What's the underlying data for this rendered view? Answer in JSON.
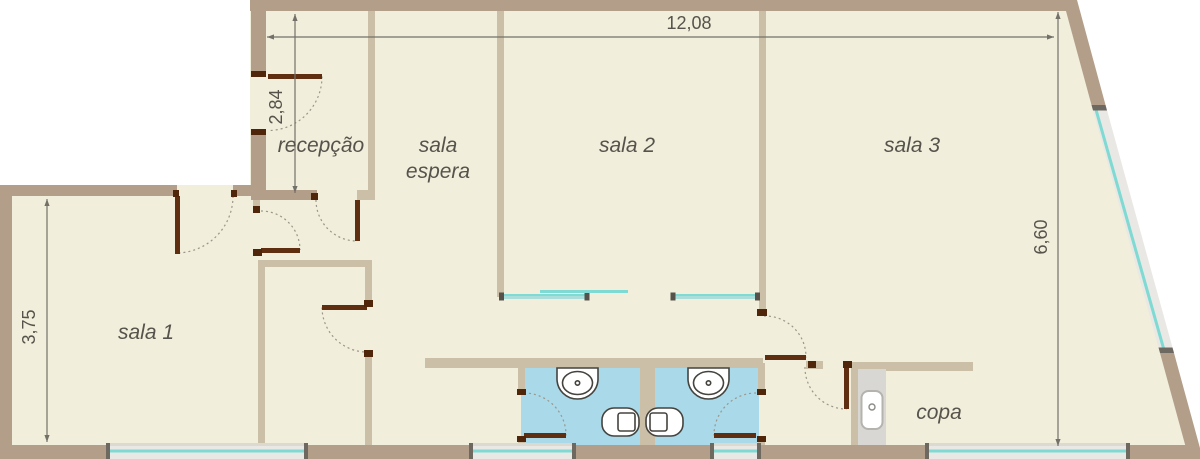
{
  "plan": {
    "type": "floor-plan",
    "rooms": [
      {
        "name": "recepcao",
        "label": "recepção"
      },
      {
        "name": "sala-espera",
        "label1": "sala",
        "label2": "espera"
      },
      {
        "name": "sala-2",
        "label": "sala 2"
      },
      {
        "name": "sala-3",
        "label": "sala 3"
      },
      {
        "name": "sala-1",
        "label": "sala 1"
      },
      {
        "name": "copa",
        "label": "copa"
      }
    ],
    "dimensions": [
      {
        "name": "overall-width",
        "label": "12,08",
        "orientation": "horizontal"
      },
      {
        "name": "recepcao-depth",
        "label": "2,84",
        "orientation": "vertical"
      },
      {
        "name": "sala-1-depth",
        "label": "3,75",
        "orientation": "vertical"
      },
      {
        "name": "right-side-height",
        "label": "6,60",
        "orientation": "vertical"
      }
    ],
    "fixtures": [
      "bathroom-sink",
      "bathroom-sink",
      "toilet",
      "toilet",
      "kitchen-sink",
      "kitchen-counter"
    ],
    "features": [
      "entrance-doors-with-swing-arcs",
      "glass-sliding-partitions",
      "windows-on-bottom-wall",
      "window-on-slanted-wall",
      "two-bathrooms"
    ],
    "colors": {
      "wall_exterior": "#b39f89",
      "wall_interior": "#cbbfa7",
      "floor": "#f1eedb",
      "bathroom_floor": "#aad9e9",
      "glass": "#7edad2",
      "door_leaf": "#5f2e10",
      "window_band": "#e9e8e4",
      "counter": "#d9d7d3",
      "dimension": "#73706a",
      "label_text": "#56534c"
    }
  }
}
